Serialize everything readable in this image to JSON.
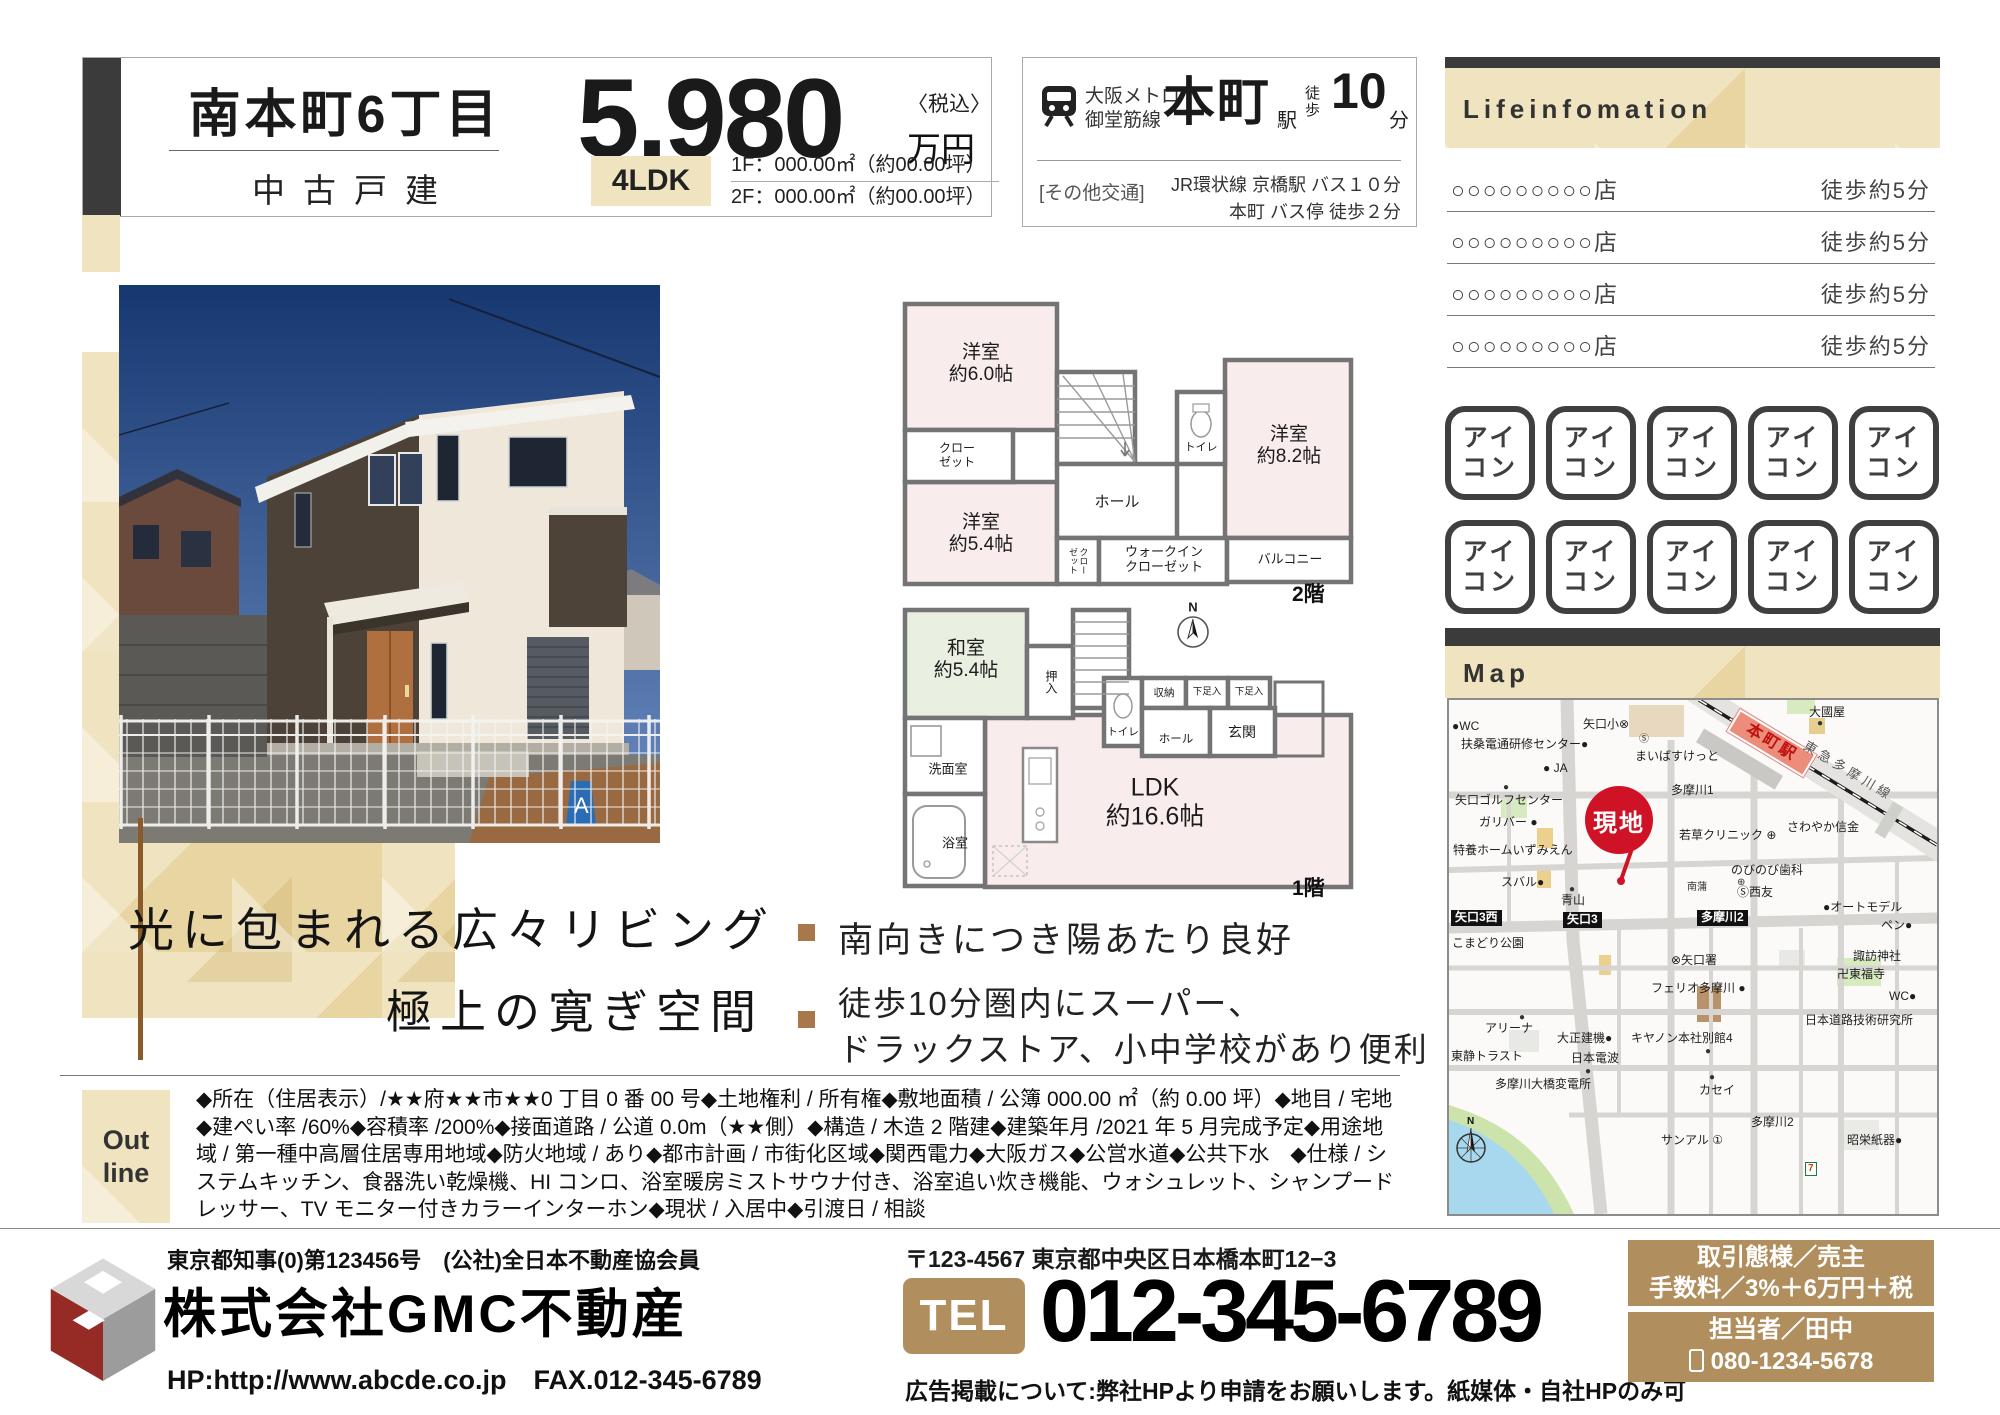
{
  "header": {
    "title": "南本町6丁目",
    "subtitle": "中古戸建",
    "price": "5,980",
    "price_tax": "〈税込〉",
    "price_unit": "万円",
    "layout_badge": "4LDK",
    "floor1_area": "1F：000.00㎡（約00.00坪）",
    "floor2_area": "2F：000.00㎡（約00.00坪）"
  },
  "access": {
    "line_name1": "大阪メトロ",
    "line_name2": "御堂筋線",
    "station": "本町",
    "station_suffix": "駅",
    "walk_label": "徒\n歩",
    "walk_min": "10",
    "walk_unit": "分",
    "other_label": "[その他交通]",
    "other1": "JR環状線 京橋駅 バス１０分",
    "other2": "本町 バス停 徒歩２分"
  },
  "lifeinfo": {
    "heading": "Lifeinfomation",
    "rows": [
      {
        "name": "○○○○○○○○○店",
        "walk": "徒歩約5分"
      },
      {
        "name": "○○○○○○○○○店",
        "walk": "徒歩約5分"
      },
      {
        "name": "○○○○○○○○○店",
        "walk": "徒歩約5分"
      },
      {
        "name": "○○○○○○○○○店",
        "walk": "徒歩約5分"
      }
    ]
  },
  "icons": {
    "label": "アイ\nコン"
  },
  "catch": {
    "line1": "光に包まれる広々リビング",
    "line2": "極上の寛ぎ空間"
  },
  "features": [
    {
      "text": "南向きにつき陽あたり良好"
    },
    {
      "text": "徒歩10分圏内にスーパー、\nドラックストア、小中学校があり便利"
    }
  ],
  "plans": {
    "f2": {
      "r60": "洋室\n約6.0帖",
      "closet": "クロー\nゼット",
      "r54": "洋室\n約5.4帖",
      "hall": "ホール",
      "toilet": "トイレ",
      "r82": "洋室\n約8.2帖",
      "closet2": "クローゼット",
      "wic": "ウォークイン\nクローゼット",
      "balcony": "バルコニー",
      "floor_label": "2階"
    },
    "f1": {
      "washitsu": "和室\n約5.4帖",
      "oshiire": "押入",
      "toilet": "トイレ",
      "shuunou": "収納",
      "geta1": "下足入",
      "geta2": "下足入",
      "genkan": "玄関",
      "hall": "ホール",
      "senmen": "洗面室",
      "bath": "浴室",
      "ldk": "LDK\n約16.6帖",
      "north": "N",
      "floor_label": "1階"
    }
  },
  "map": {
    "heading": "Map",
    "genchi": "現地",
    "pois": [
      {
        "x": 3,
        "y": 20,
        "t": "●WC"
      },
      {
        "x": 12,
        "y": 38,
        "t": "扶桑電通研修センター●"
      },
      {
        "x": 134,
        "y": 18,
        "t": "矢口小⊗"
      },
      {
        "x": 190,
        "y": 34,
        "t": "Ⓢ",
        "c": "sm"
      },
      {
        "x": 186,
        "y": 50,
        "t": "まいばすけっと"
      },
      {
        "x": 94,
        "y": 62,
        "t": "● JA"
      },
      {
        "x": 222,
        "y": 84,
        "t": "多摩川1"
      },
      {
        "x": 6,
        "y": 94,
        "t": "矢口ゴルフセンター"
      },
      {
        "x": 54,
        "y": 82,
        "t": "●",
        "c": "sm"
      },
      {
        "x": 30,
        "y": 116,
        "t": "ガリバー ●"
      },
      {
        "x": 4,
        "y": 144,
        "t": "特養ホームいずみえん"
      },
      {
        "x": 230,
        "y": 129,
        "t": "若草クリニック ⊕"
      },
      {
        "x": 338,
        "y": 121,
        "t": "さわやか信金"
      },
      {
        "x": 282,
        "y": 164,
        "t": "のびのび歯科"
      },
      {
        "x": 288,
        "y": 177,
        "t": "⊕",
        "c": "sm"
      },
      {
        "x": 238,
        "y": 182,
        "t": "南蒲",
        "c": "sm"
      },
      {
        "x": 288,
        "y": 186,
        "t": "Ⓢ西友"
      },
      {
        "x": 52,
        "y": 176,
        "t": "スバル●"
      },
      {
        "x": 120,
        "y": 184,
        "t": "●",
        "c": "sm"
      },
      {
        "x": 112,
        "y": 194,
        "t": "青山"
      },
      {
        "x": 2,
        "y": 210,
        "t": "矢口3西",
        "c": "b"
      },
      {
        "x": 114,
        "y": 212,
        "t": "矢口3",
        "c": "b"
      },
      {
        "x": 248,
        "y": 210,
        "t": "多摩川2",
        "c": "b"
      },
      {
        "x": 374,
        "y": 201,
        "t": "●オートモデル"
      },
      {
        "x": 432,
        "y": 219,
        "t": "ペン●"
      },
      {
        "x": 3,
        "y": 237,
        "t": "こまどり公園"
      },
      {
        "x": 360,
        "y": 6,
        "t": "大國屋"
      },
      {
        "x": 368,
        "y": 18,
        "t": "●",
        "c": "sm"
      },
      {
        "x": 278,
        "y": 30,
        "t": "本町駅",
        "c": "s"
      },
      {
        "x": 348,
        "y": 64,
        "t": "東急多摩川線",
        "c": "r"
      },
      {
        "x": 222,
        "y": 254,
        "t": "⊗矢口署"
      },
      {
        "x": 202,
        "y": 282,
        "t": "フェリオ多摩川 ●"
      },
      {
        "x": 36,
        "y": 322,
        "t": "アリーナ"
      },
      {
        "x": 70,
        "y": 312,
        "t": "●",
        "c": "sm"
      },
      {
        "x": 108,
        "y": 332,
        "t": "大正建機●"
      },
      {
        "x": 182,
        "y": 332,
        "t": "キヤノン本社別館4"
      },
      {
        "x": 256,
        "y": 346,
        "t": "●",
        "c": "sm"
      },
      {
        "x": 2,
        "y": 350,
        "t": "東静トラスト"
      },
      {
        "x": 122,
        "y": 352,
        "t": "日本電波"
      },
      {
        "x": 136,
        "y": 366,
        "t": "●",
        "c": "sm"
      },
      {
        "x": 46,
        "y": 378,
        "t": "多摩川大橋変電所"
      },
      {
        "x": 260,
        "y": 372,
        "t": "●",
        "c": "sm"
      },
      {
        "x": 250,
        "y": 384,
        "t": "カセイ"
      },
      {
        "x": 302,
        "y": 416,
        "t": "多摩川2"
      },
      {
        "x": 212,
        "y": 434,
        "t": "サンアル ①"
      },
      {
        "x": 398,
        "y": 434,
        "t": "昭栄紙器●"
      },
      {
        "x": 404,
        "y": 250,
        "t": "諏訪神社"
      },
      {
        "x": 388,
        "y": 268,
        "t": "卍東福寺"
      },
      {
        "x": 440,
        "y": 290,
        "t": "WC●"
      },
      {
        "x": 356,
        "y": 314,
        "t": "日本道路技術研究所"
      },
      {
        "x": 356,
        "y": 462,
        "t": "7",
        "c": "v"
      }
    ]
  },
  "outline": {
    "label": "Out\nline",
    "text": "◆所在（住居表示）/★★府★★市★★0 丁目 0 番 00 号◆土地権利 / 所有権◆敷地面積 / 公簿 000.00 ㎡（約 0.00 坪）◆地目 / 宅地◆建ぺい率 /60%◆容積率 /200%◆接面道路 / 公道 0.0m（★★側）◆構造 / 木造 2 階建◆建築年月 /2021 年 5 月完成予定◆用途地域 / 第一種中高層住居専用地域◆防火地域 / あり◆都市計画 / 市街化区域◆関西電力◆大阪ガス◆公営水道◆公共下水　◆仕様 / システムキッチン、食器洗い乾燥機、HI コンロ、浴室暖房ミストサウナ付き、浴室追い炊き機能、ウォシュレット、シャンプードレッサー、TV モニター付きカラーインターホン◆現状 / 入居中◆引渡日 / 相談"
  },
  "footer": {
    "license": "東京都知事(0)第123456号　(公社)全日本不動産協会員",
    "company": "株式会社GMC不動産",
    "hp": "HP:http://www.abcde.co.jp　FAX.012-345-6789",
    "address": "〒123-4567  東京都中央区日本橋本町12−3",
    "tel_label": "TEL",
    "tel": "012-345-6789",
    "ad_note": "広告掲載について:弊社HPより申請をお願いします。紙媒体・自社HPのみ可",
    "deal_line1": "取引態様／売主",
    "deal_line2": "手数料／3%＋6万円＋税",
    "agent_line1": "担当者／田中",
    "agent_line2": "080-1234-5678"
  },
  "colors": {
    "accent_tan": "#b08e5d",
    "beige": "#ecdcae",
    "dark": "#3b3b3b",
    "red": "#cf1225"
  }
}
